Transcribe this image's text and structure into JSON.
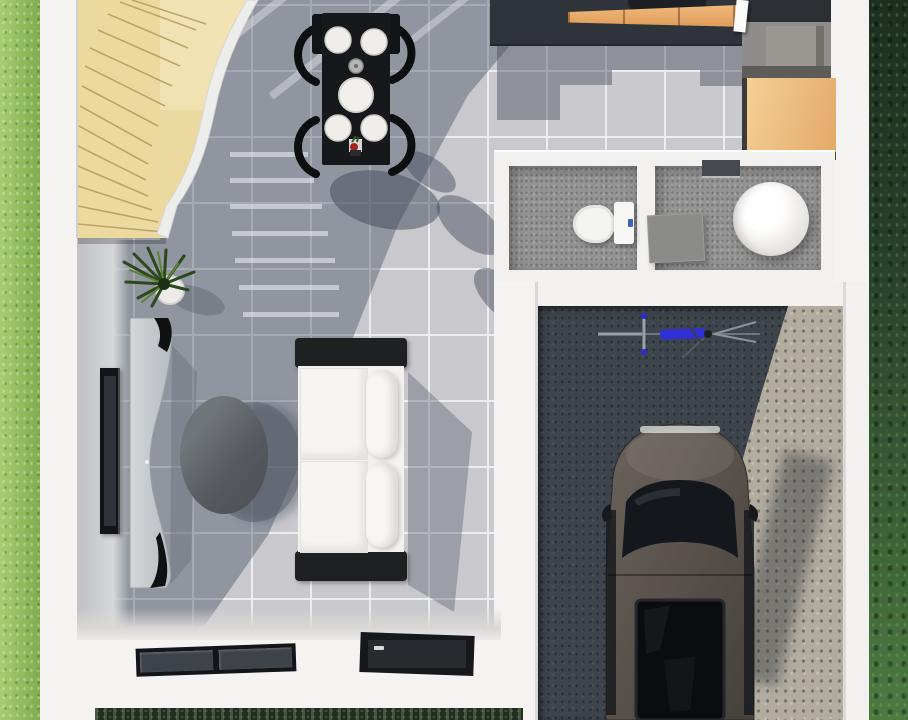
{
  "scene": {
    "type": "3d-rendered-floor-plan",
    "view": "top-down"
  },
  "palette": {
    "grass_left": "#8fbf5c",
    "grass_right": "#2f4a2e",
    "wall": "#f4f3f1",
    "wall_inner": "#c7c9ca",
    "tile": "#c9c9cd",
    "grout": "#ebedef",
    "shadow": "rgba(70,78,95,0.42)",
    "stair_wood": "#ecd9a0",
    "stair_stringer": "#ededeb",
    "black_furniture": "#17181b",
    "plate_white": "#efeeeb",
    "counter_dark": "#2f343a",
    "cabinet_orange": "#eaa96b",
    "cabinet_tan": "#f0c38b",
    "counter_gray": "#8f8d8b",
    "appliance_gray": "#9a9691",
    "bath_floor": "#949494",
    "porcelain": "#f4f4f2",
    "mat_gray": "#8b8b89",
    "flush_button_blue": "#3a62c8",
    "garage_dark": "#3e444c",
    "garage_light": "#b2ac9f",
    "car_body": "#56504a",
    "car_glass": "#14171c",
    "bike_blue": "#2f2fd6",
    "sofa_white": "#f3f2ef",
    "sofa_black": "#1f2022",
    "console_gray": "#c6cbd0",
    "coffee_table_gray": "#5f6368",
    "tv_black": "#131417",
    "plant_green": "#2c481d",
    "pot_white": "#ecebe8",
    "window_frame": "#141518",
    "window_glass": "#3e434a",
    "door_dark": "#17181b",
    "hedge_dark": "#202c1d",
    "vase_red": "#a32222"
  },
  "rooms": [
    {
      "name": "dining-area",
      "floor": "gray-tile"
    },
    {
      "name": "kitchen",
      "floor": "gray-tile"
    },
    {
      "name": "living-area",
      "floor": "gray-tile"
    },
    {
      "name": "bathroom-wc",
      "floor": "speckled-gray"
    },
    {
      "name": "bathroom-shower",
      "floor": "speckled-gray"
    },
    {
      "name": "garage",
      "floor": "concrete"
    }
  ],
  "furniture": [
    {
      "name": "staircase",
      "material": "wood",
      "shape": "curved-winder"
    },
    {
      "name": "dining-table",
      "chairs_visible": 4,
      "place_settings": 4
    },
    {
      "name": "kitchen-counter"
    },
    {
      "name": "kitchen-sink"
    },
    {
      "name": "tall-cabinet"
    },
    {
      "name": "toilet"
    },
    {
      "name": "round-bathtub"
    },
    {
      "name": "shower-mat"
    },
    {
      "name": "sofa",
      "seats": 2
    },
    {
      "name": "coffee-table",
      "shape": "oval"
    },
    {
      "name": "wall-tv"
    },
    {
      "name": "tv-console",
      "shape": "s-curve"
    },
    {
      "name": "houseplant"
    },
    {
      "name": "car"
    },
    {
      "name": "bicycle"
    },
    {
      "name": "double-window"
    },
    {
      "name": "entry-door"
    }
  ]
}
